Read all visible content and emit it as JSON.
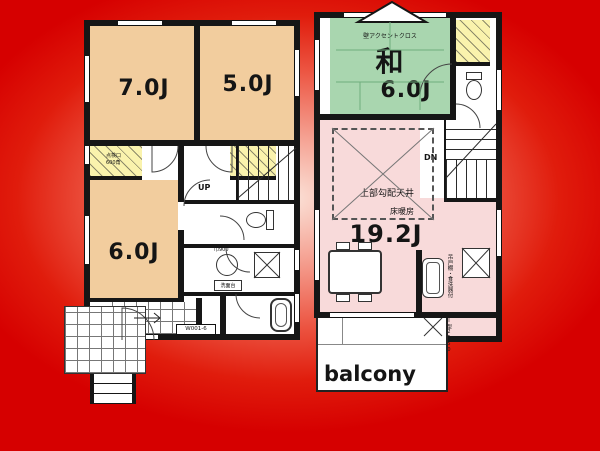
{
  "background": {
    "gradient_center": "#fbe3d9",
    "gradient_edge": "#d60000"
  },
  "palette": {
    "wall": "#161616",
    "room_tan": "#f2cd9e",
    "room_green": "#a9d6af",
    "room_pink": "#f8dada",
    "closet_yellow": "#faf3ad"
  },
  "floor1": {
    "room_top_left": {
      "area": "7.0J"
    },
    "room_top_right": {
      "area": "5.0J"
    },
    "room_mid_left": {
      "area": "6.0J"
    },
    "stair_direction": "UP",
    "hatch_note_line1": "点検口",
    "hatch_note_line2": "600角",
    "basin_note": "巾900",
    "vanity_note": "洗面台",
    "entry_door_code": "W001-6"
  },
  "floor2": {
    "tatami_room": {
      "name": "和",
      "area": "6.0J",
      "wall_note": "壁アクセントクロス"
    },
    "living_room": {
      "area": "19.2J",
      "ceiling_note": "上部勾配天井",
      "floor_note": "床暖房"
    },
    "stair_direction": "DN",
    "kitchen_note": "吊戸棚・食洗器付",
    "kitchen_size_note": "I型2550",
    "balcony_label": "balcony"
  }
}
